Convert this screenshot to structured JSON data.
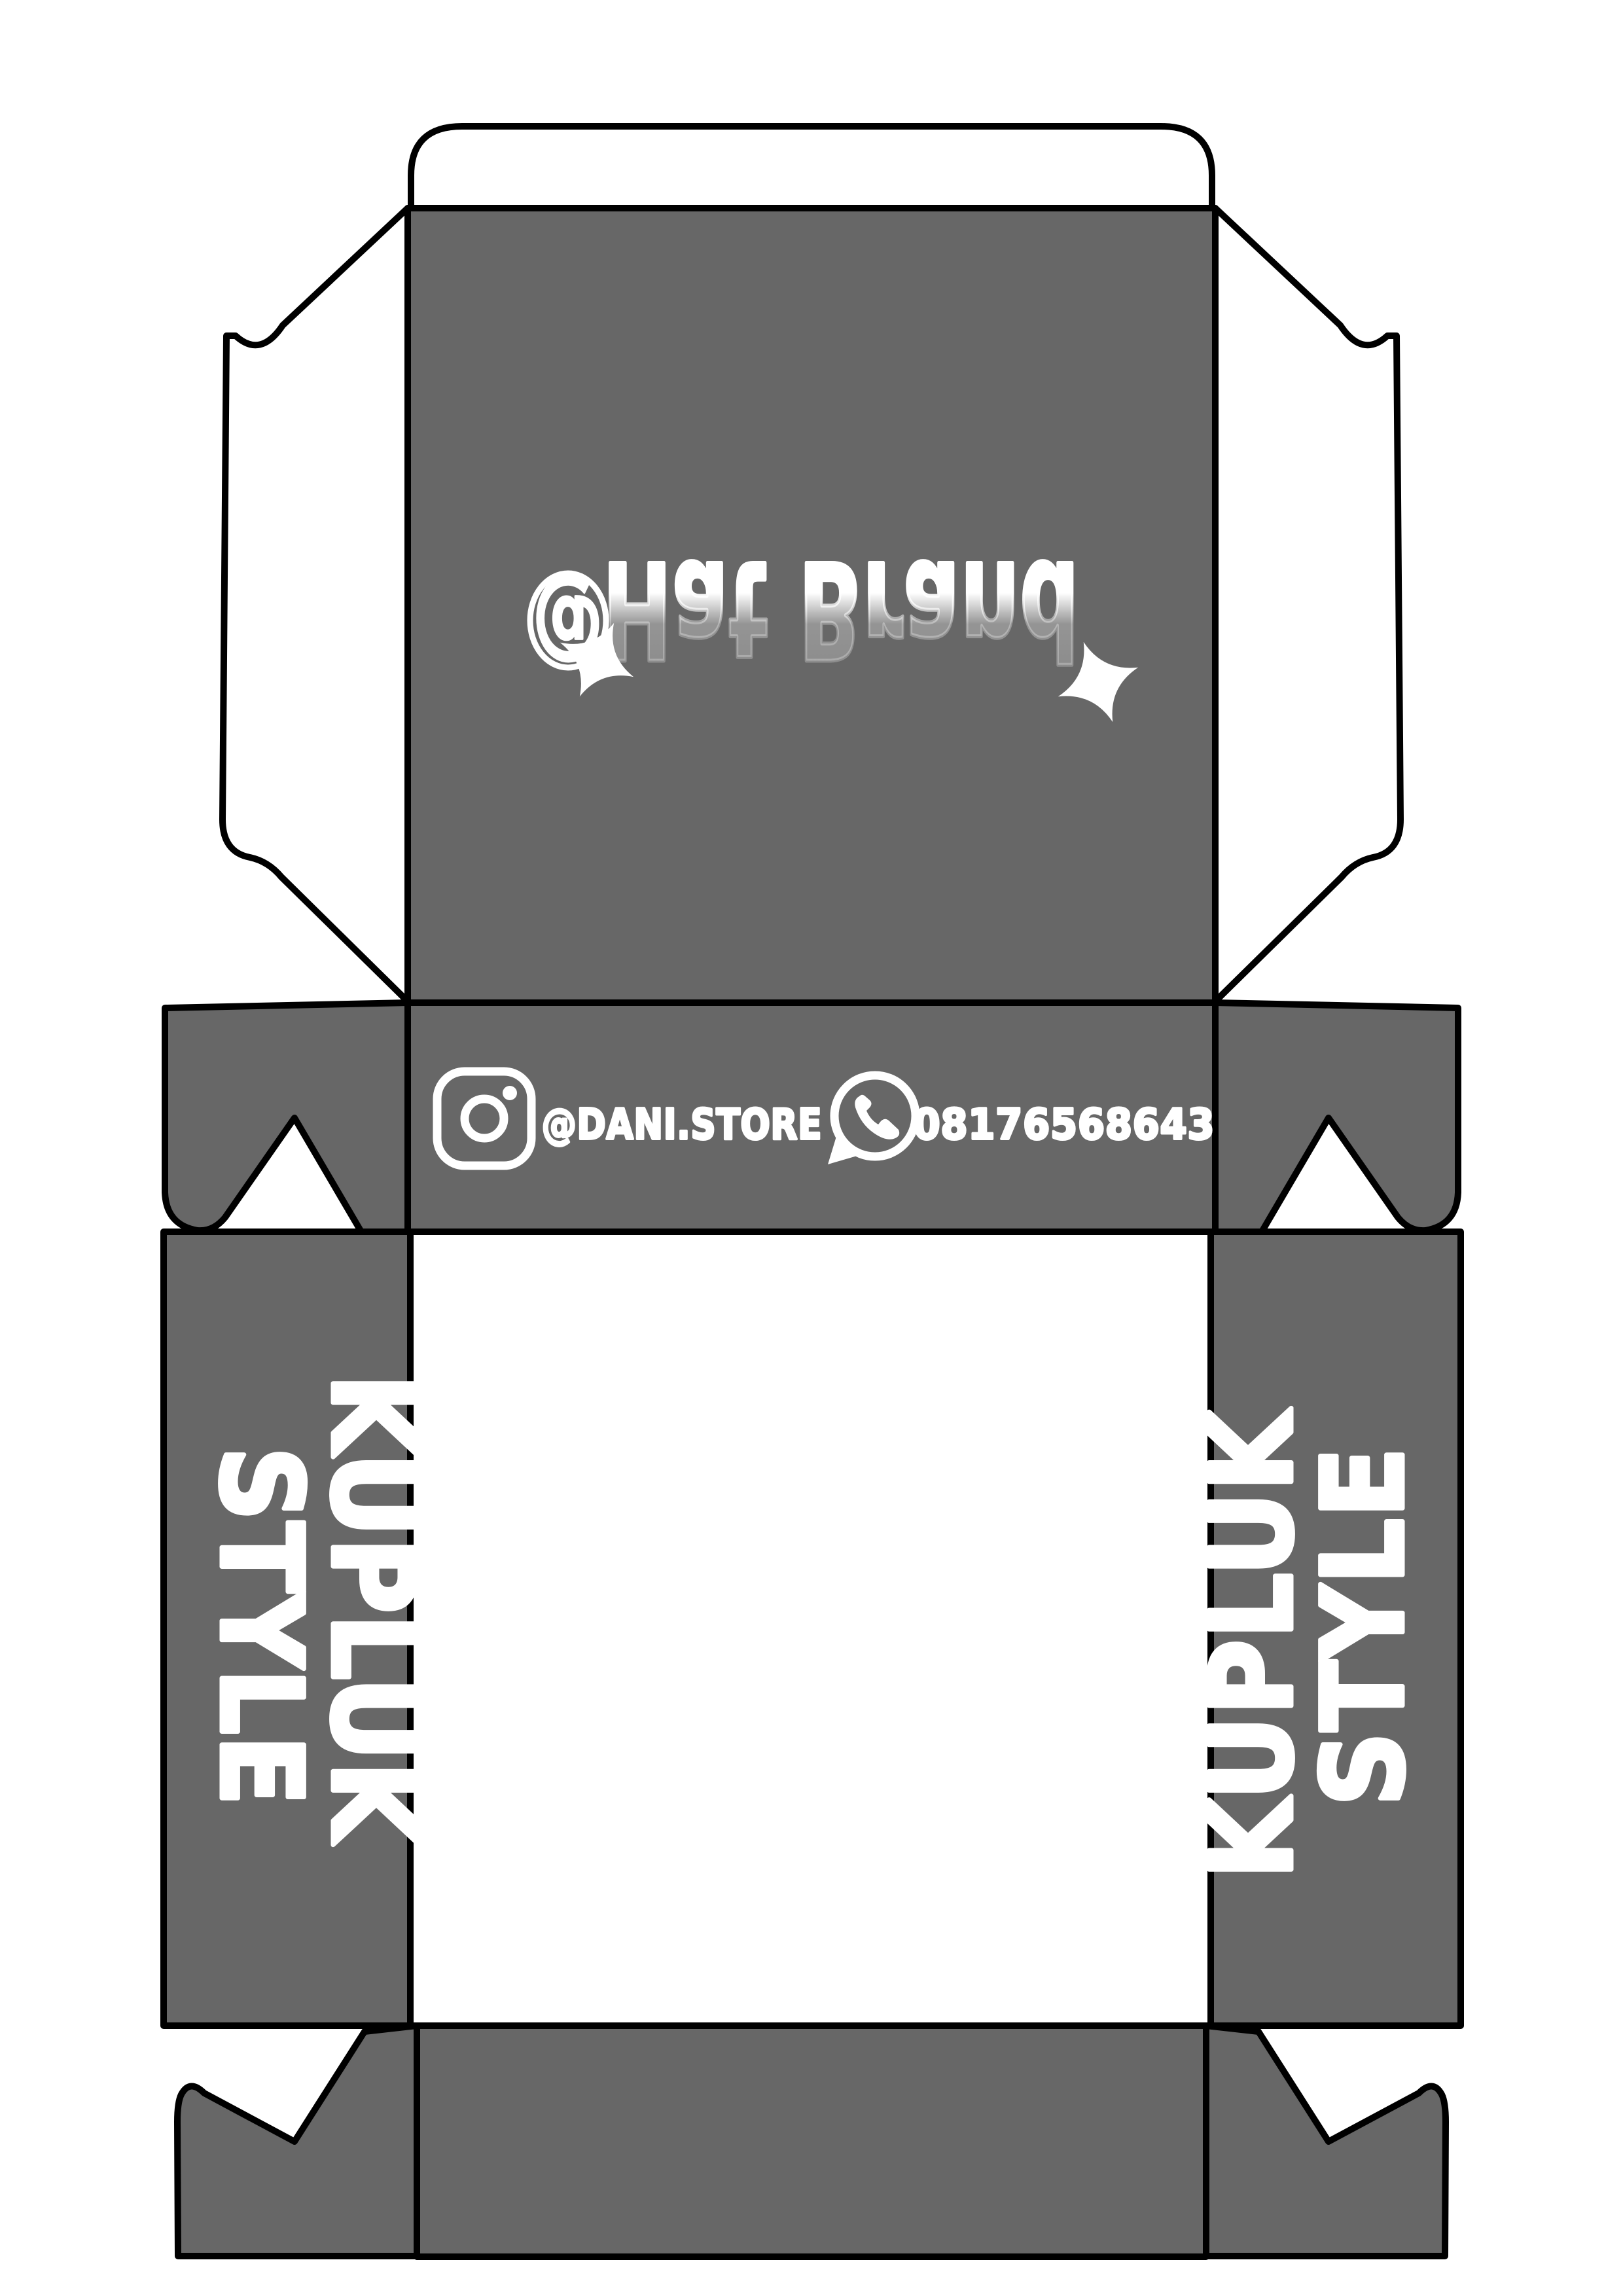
{
  "colors": {
    "panel_gray": "#676767",
    "cut_line": "#000000",
    "artwork_white": "#ffffff",
    "page_background": "#ffffff"
  },
  "lid_panel": {
    "at_symbol": "@",
    "brand_name": "Hat Brand"
  },
  "contact_strip": {
    "instagram_handle": "@DANI.STORE",
    "whatsapp_number": "08176568643"
  },
  "side_panel_text": {
    "line1": "KUPLUK",
    "line2": "STYLE"
  }
}
